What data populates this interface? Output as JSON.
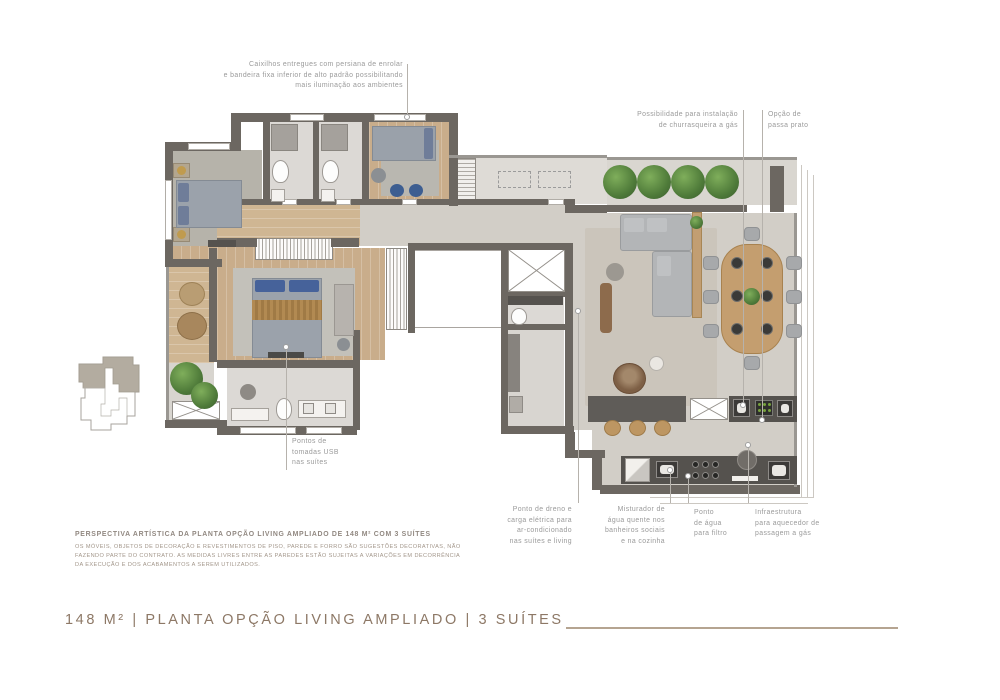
{
  "annotations": {
    "caixilhos": "Caixilhos entregues com persiana de enrolar\ne bandeira fixa inferior de alto padrão possibilitando\nmais iluminação aos ambientes",
    "churrasqueira": "Possibilidade para instalação\nde churrasqueira a gás",
    "passa_prato": "Opção de\npassa prato",
    "usb": "Pontos de\ntomadas USB\nnas suítes",
    "dreno": "Ponto de dreno e\ncarga elétrica para\nar-condicionado\nnas suítes e living",
    "misturador": "Misturador de\nágua quente nos\nbanheiros sociais\ne na cozinha",
    "filtro": "Ponto\nde água\npara filtro",
    "aquecedor": "Infraestrutura\npara aquecedor de\npassagem a gás"
  },
  "footer": {
    "perspective_title": "PERSPECTIVA ARTÍSTICA DA PLANTA OPÇÃO LIVING AMPLIADO DE 148 M² COM 3 SUÍTES",
    "disclaimer": "OS MÓVEIS, OBJETOS DE DECORAÇÃO E REVESTIMENTOS DE PISO, PAREDE E FORRO SÃO SUGESTÕES DECORATIVAS, NÃO\nFAZENDO PARTE DO CONTRATO. AS MEDIDAS LIVRES ENTRE AS PAREDES ESTÃO SUJEITAS A VARIAÇÕES EM DECORRÊNCIA\nDA EXECUÇÃO E DOS ACABAMENTOS A SEREM UTILIZADOS."
  },
  "plan_title": {
    "text": "148 M² | PLANTA OPÇÃO LIVING AMPLIADO | 3 SUÍTES"
  },
  "colors": {
    "wall": "#6c6761",
    "wood_floor": "#c9ad8b",
    "title_accent": "#8d7866",
    "annotation_gray": "#9a9a9a",
    "plant_green": "#4e7a39",
    "rule_tan": "#b5a491"
  }
}
